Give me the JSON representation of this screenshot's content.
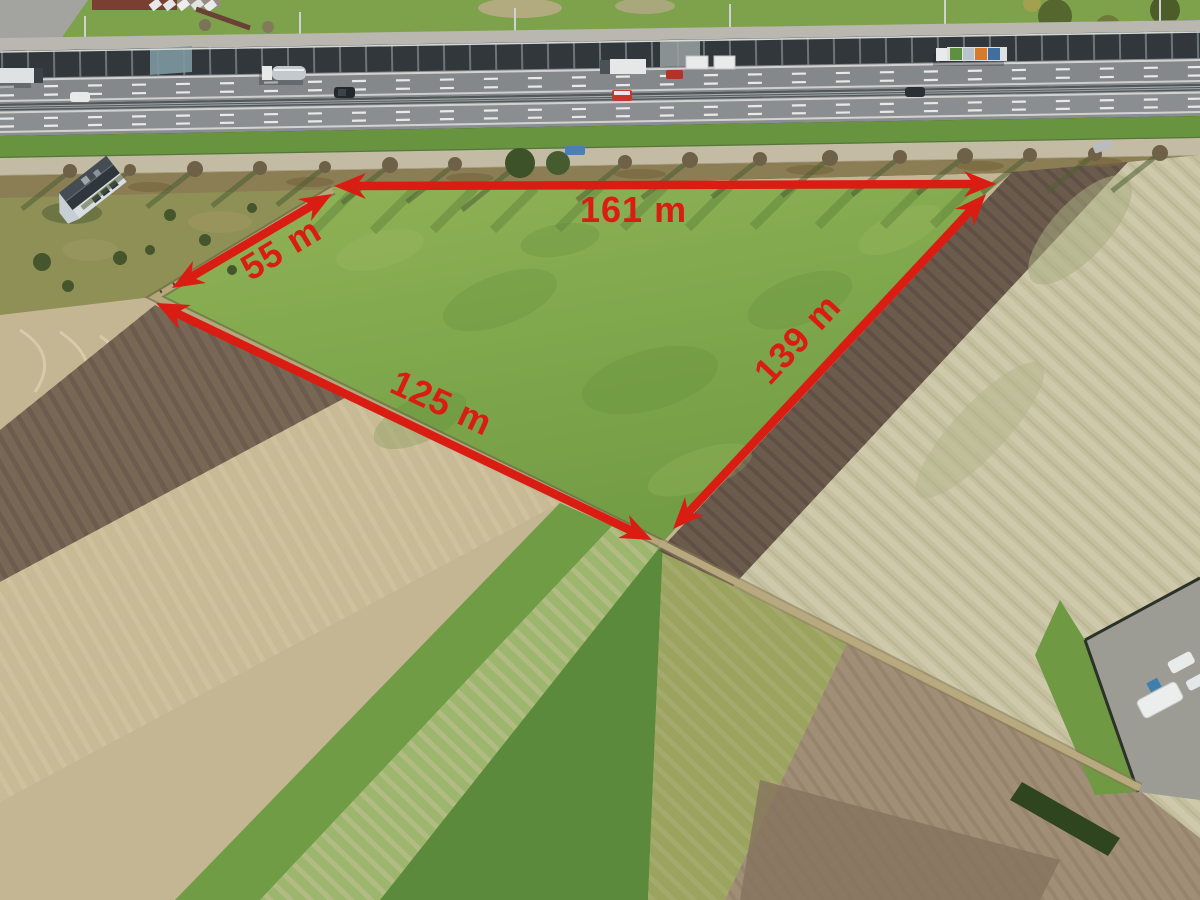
{
  "annotation": {
    "color": "#da1d13",
    "unit": "m",
    "measurements": [
      {
        "side": "top",
        "label": "161 m",
        "value": 161
      },
      {
        "side": "upper-left",
        "label": "55 m",
        "value": 55
      },
      {
        "side": "lower-left",
        "label": "125 m",
        "value": 125
      },
      {
        "side": "right",
        "label": "139 m",
        "value": 139
      }
    ]
  },
  "palette": {
    "annotation_red": "#da1d13",
    "parcel_green": "#82a94e",
    "plowed_dark_brown": "#6b5b4d",
    "stubble_tan": "#c4b593",
    "pale_field": "#c6c0a0",
    "asphalt_gray": "#87898c",
    "noise_barrier": "#31373a",
    "embankment_green": "#69943f"
  }
}
